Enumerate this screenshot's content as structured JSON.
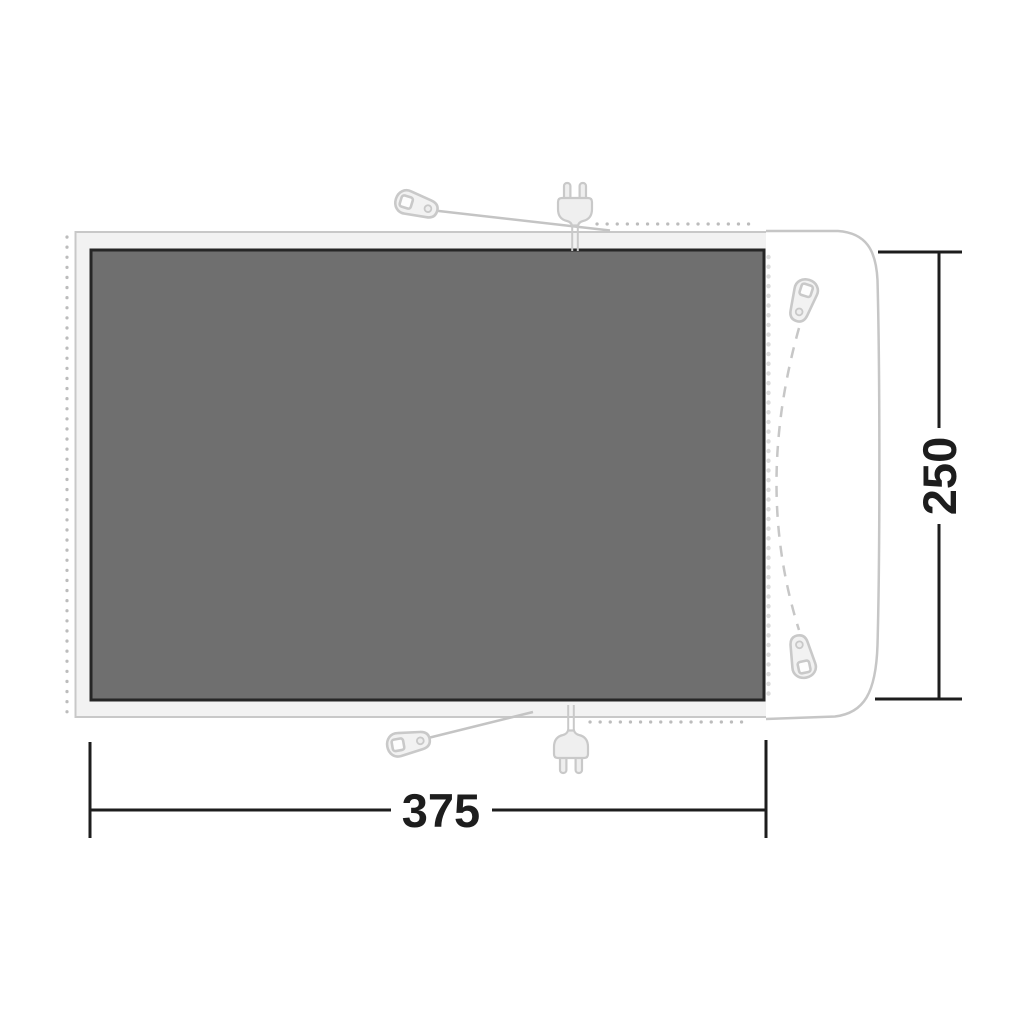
{
  "diagram": {
    "type": "awning-groundsheet-floorplan",
    "labels": {
      "width": "375",
      "depth": "250"
    },
    "colors": {
      "background": "#ffffff",
      "mat_fill": "#6f6f6f",
      "mat_border": "#262626",
      "band_fill": "#f2f2f2",
      "band_stroke": "#c8c8c8",
      "cabin_fill": "#ffffff",
      "cabin_stroke": "#c6c6c6",
      "icon_fill": "#f0f0f0",
      "icon_stroke": "#c9c9c9",
      "dot_gray": "#bcbcbc",
      "zipper_teeth": "#dcdcdc",
      "dimension_color": "#1d1d1d"
    },
    "icons": {
      "peg": "guy-line-peg-tag",
      "plug": "power-plug-two-prong",
      "zipper_pull": "zipper-pull-tag"
    }
  }
}
